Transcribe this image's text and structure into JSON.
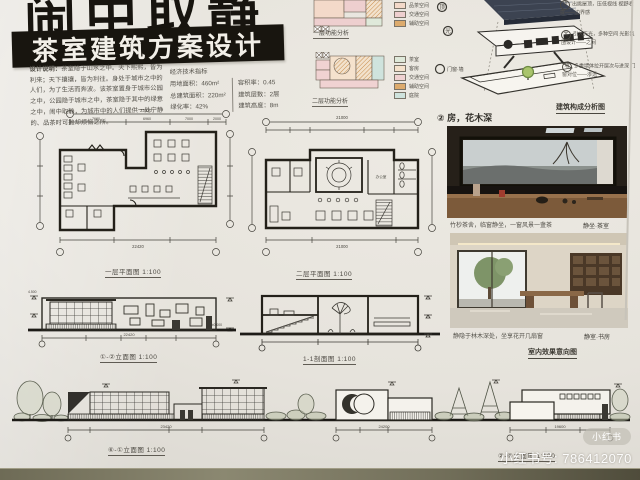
{
  "watermark": {
    "badge": "小红书",
    "id_text": "小红书号: 786412070"
  },
  "header": {
    "main_title": "闹中取静",
    "banner": "茶室建筑方案设计"
  },
  "intro": {
    "design_note_label": "设计说明：",
    "design_note": "茶室隐于山水之中。天下熙熙，皆为利来；天下攘攘，皆为利往。身处于城市之中的人们，为了生活而奔波。该茶室置身于城市公园之中，公园隐于城市之中，茶室隐于其中的绿意之中，闹中取静，为城市中的人们提供一处宁静的、品茶时可抛却烦恼之所。",
    "indicators_title": "经济技术指标",
    "indicators_col1": [
      "用地面积：460m²",
      "总建筑面积：220m²",
      "绿化率：42%"
    ],
    "indicators_col2": [
      "容积率：0.45",
      "建筑层数：2层",
      "建筑高度：8m"
    ]
  },
  "analysis": {
    "func1_label": "一层功能分析",
    "func1_legend": [
      "品茶空间",
      "交通空间",
      "辅助空间"
    ],
    "func1_colors": [
      "#f3d9c9",
      "#eecfcf",
      "#ddab6d"
    ],
    "func2_label": "二层功能分析",
    "func2_legend": [
      "茶室",
      "客房",
      "交通空间",
      "辅助空间",
      "庭院"
    ],
    "func2_colors": [
      "#dfe9da",
      "#f5e2cd",
      "#f0d2d2",
      "#ddab6d",
      "#cfe3dd"
    ],
    "composition_label": "建筑构成分析图",
    "callouts": [
      "顶",
      "光",
      "门窗·墙"
    ],
    "notes": [
      {
        "tag": "顶",
        "text": "出挑屋顶，压低视线 视野收拢——边界感"
      },
      {
        "tag": "光",
        "text": "引入天光，多种空间 光影氛围设计——之间"
      },
      {
        "tag": "墙",
        "text": "多重墙体拉开层次与进深 门窗对位——渗透"
      }
    ]
  },
  "drawings": {
    "plan1": {
      "label": "一层平面图 1:100",
      "dim_top": "23420",
      "dim_top_segs": [
        "7680",
        "6960",
        "7000",
        "2000"
      ],
      "dim_bottom": "22420"
    },
    "plan2": {
      "label": "二层平面图 1:100",
      "dim_top": "21000",
      "dim_bottom": "21000",
      "room": "办公室"
    },
    "elev12": {
      "label": "①-②立面图 1:100",
      "dim": "22420",
      "lvl_top": "4.500",
      "lvl_zero": "±0.000"
    },
    "sec11": {
      "label": "1-1剖面图 1:100"
    },
    "elev_bl": {
      "label": "⑥-①立面图 1:100",
      "dim": "23420"
    },
    "elev_br": {
      "label": "②-⑥立面图 1:100",
      "dim_left": "24200",
      "dim_right": "19600"
    }
  },
  "gallery": {
    "section_title": "② 房，花木深",
    "photo1_caption": "竹杪茶舍，临窗静坐，一窗风景一盏茶",
    "photo1_tag": "静坐·茶室",
    "photo2_caption": "静隐于林木深处，坐享花开几扇窗",
    "photo2_tag": "静室·书房",
    "gallery_label": "室内效果意向图"
  }
}
